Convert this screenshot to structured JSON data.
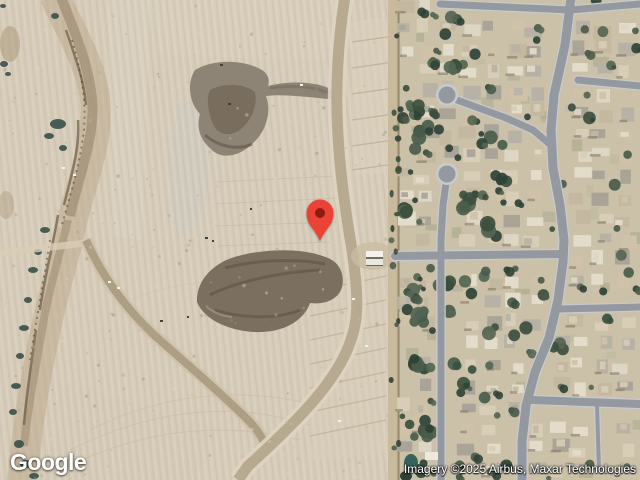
{
  "map": {
    "logo_text": "Google",
    "attribution_text": "Imagery ©2025 Airbus, Maxar Technologies",
    "marker": {
      "x": 320,
      "y": 243,
      "color": "#EA4335",
      "dot_color": "#8F1B10"
    },
    "palette": {
      "desert_base": "#d6cbb8",
      "neighborhood_base": "#cbc0a8",
      "street": "#94989f",
      "street_curb": "#c7cacf",
      "tree_greens": [
        "#4a5c4b",
        "#3c4f3f",
        "#556654",
        "#2f4237"
      ],
      "house_tans": [
        "#d8cdb6",
        "#cfc2a8",
        "#c4b8a0",
        "#b8b2a6",
        "#a9a398",
        "#ded6c4",
        "#e4dccb"
      ],
      "lawn_greens": [
        "#a8aa8c",
        "#b9b79c",
        "#9fa383"
      ],
      "dark_soil": "#7b7060",
      "wash_brown": "#8f7e66",
      "scrub_teal": "#3a534c"
    }
  }
}
